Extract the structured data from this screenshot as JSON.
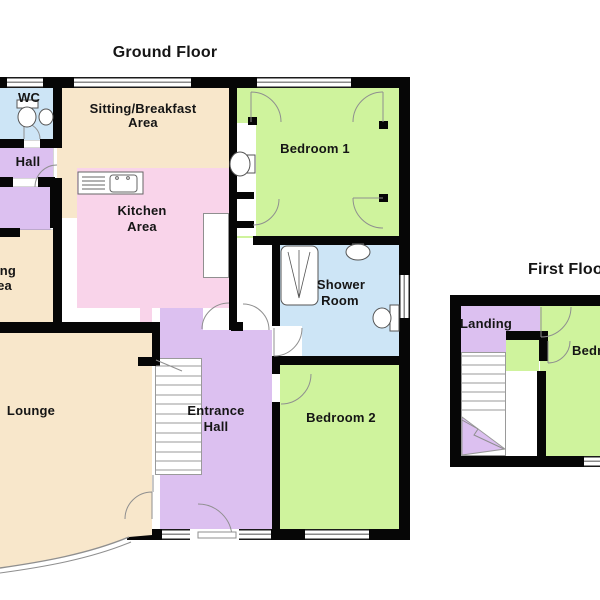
{
  "ground_floor": {
    "title": "Ground Floor",
    "rooms": {
      "wc": "WC",
      "hall": "Hall",
      "sitting_line1": "Sitting/Breakfast",
      "sitting_line2": "Area",
      "kitchen_line1": "Kitchen",
      "kitchen_line2": "Area",
      "dining_line1": "Dining",
      "dining_line2": "Area",
      "lounge": "Lounge",
      "entrance_line1": "Entrance",
      "entrance_line2": "Hall",
      "bedroom1": "Bedroom 1",
      "shower_line1": "Shower",
      "shower_line2": "Room",
      "bedroom2": "Bedroom 2"
    }
  },
  "first_floor": {
    "title": "First Floor",
    "rooms": {
      "landing": "Landing",
      "bedroom3": "Bedroom 3"
    }
  },
  "colors": {
    "wall": "#060606",
    "line": "#8f8f8f",
    "room_cream": "#f8e7cb",
    "room_pink": "#f9d4ea",
    "room_green": "#cff39d",
    "room_blue": "#cde5f6",
    "room_purple": "#dcc0f0",
    "stairs_white": "#ffffff"
  }
}
